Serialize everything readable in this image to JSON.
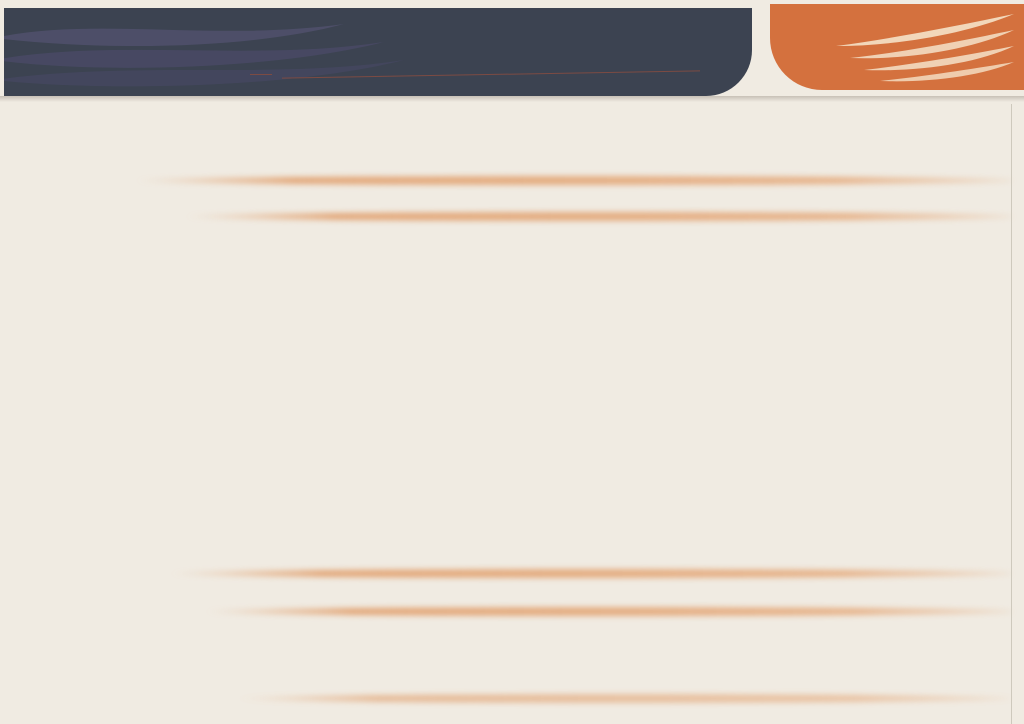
{
  "header": {
    "brand": "THE MRT-CITY",
    "floor_number": "20",
    "floor_label": "樓層",
    "title": "平面參考圖",
    "subtitle": "THE MRT CITY",
    "colors": {
      "bg": "#3c4351",
      "brand": "#5f5b85",
      "subtitle": "#a75e48"
    }
  },
  "tagline": {
    "line1": "The world",
    "line2": "within my grasp",
    "colors": {
      "bg": "#d4713e",
      "text": "#f6e3cd"
    }
  },
  "unit_labels": {
    "top": [
      {
        "id": "A9",
        "sep": ">",
        "area": "17.81",
        "suffix": "坪"
      },
      {
        "id": "A8",
        "sep": ">",
        "area": "17.11",
        "suffix": "坪"
      },
      {
        "id": "A7",
        "sep": ">",
        "area": "17.1",
        "suffix": "坪"
      },
      {
        "id": "A6",
        "sep": ">",
        "area": "17.11",
        "suffix": "坪"
      },
      {
        "id": "A5",
        "sep": ">",
        "area": "17.1",
        "suffix": "坪"
      },
      {
        "id": "A4",
        "sep": ">",
        "area": "17.1",
        "suffix": "坪"
      },
      {
        "id": "A3",
        "sep": ">",
        "area": "17.11",
        "suffix": "坪"
      },
      {
        "id": "A2",
        "sep": ">",
        "area": "17.1",
        "suffix": "坪"
      },
      {
        "id": "A1",
        "sep": ">",
        "area": "16.35",
        "suffix": "坪"
      }
    ],
    "bottom": [
      {
        "id": "A10",
        "sep": ">",
        "area": "20.97",
        "suffix": "坪"
      },
      {
        "id": "A11",
        "sep": ">",
        "area": "17.79",
        "suffix": "坪"
      },
      {
        "id": "A12",
        "sep": ">",
        "area": "16.58",
        "suffix": "坪"
      },
      {
        "id": "A13",
        "sep": ">",
        "area": "27.67",
        "suffix": "坪"
      },
      {
        "id": "A14",
        "sep": ">",
        "area": "27.38",
        "suffix": "坪"
      }
    ]
  },
  "plan": {
    "top_units": [
      {
        "id": "A9",
        "tone": "pink"
      },
      {
        "id": "A8",
        "tone": "cream"
      },
      {
        "id": "A7",
        "tone": "pink"
      },
      {
        "id": "A6",
        "tone": "cream"
      },
      {
        "id": "A5",
        "tone": "pink"
      },
      {
        "id": "A4",
        "tone": "cream"
      },
      {
        "id": "A3",
        "tone": "pink"
      },
      {
        "id": "A2",
        "tone": "cream"
      },
      {
        "id": "A1",
        "tone": "pink"
      }
    ],
    "bottom_units": [
      {
        "id": "A10",
        "tone": "cream"
      },
      {
        "id": "A11",
        "tone": "pink"
      },
      {
        "id": "A12",
        "tone": "cream"
      },
      {
        "id": "A13",
        "tone": "pink"
      },
      {
        "id": "A14",
        "tone": "cream"
      }
    ],
    "labels": {
      "balcony": "陽台",
      "terrace": "露臺",
      "canopy": "雨遮"
    },
    "colors": {
      "pink": "#f2cbbd",
      "pink_light": "#f7dcd2",
      "cream": "#eae7d3",
      "cream_light": "#f1efdf",
      "core": "#d7ded2",
      "corridor": "#dde3d8",
      "stair": "#ccdad6",
      "wall": "#4a4a42",
      "line": "#8f8f84",
      "watermark": "#8cc8e8"
    }
  },
  "footer": {
    "disclaimer": "景觀與室內格局配置圖僅供參考‧實際圖面以建照圖及合約附件為準"
  }
}
